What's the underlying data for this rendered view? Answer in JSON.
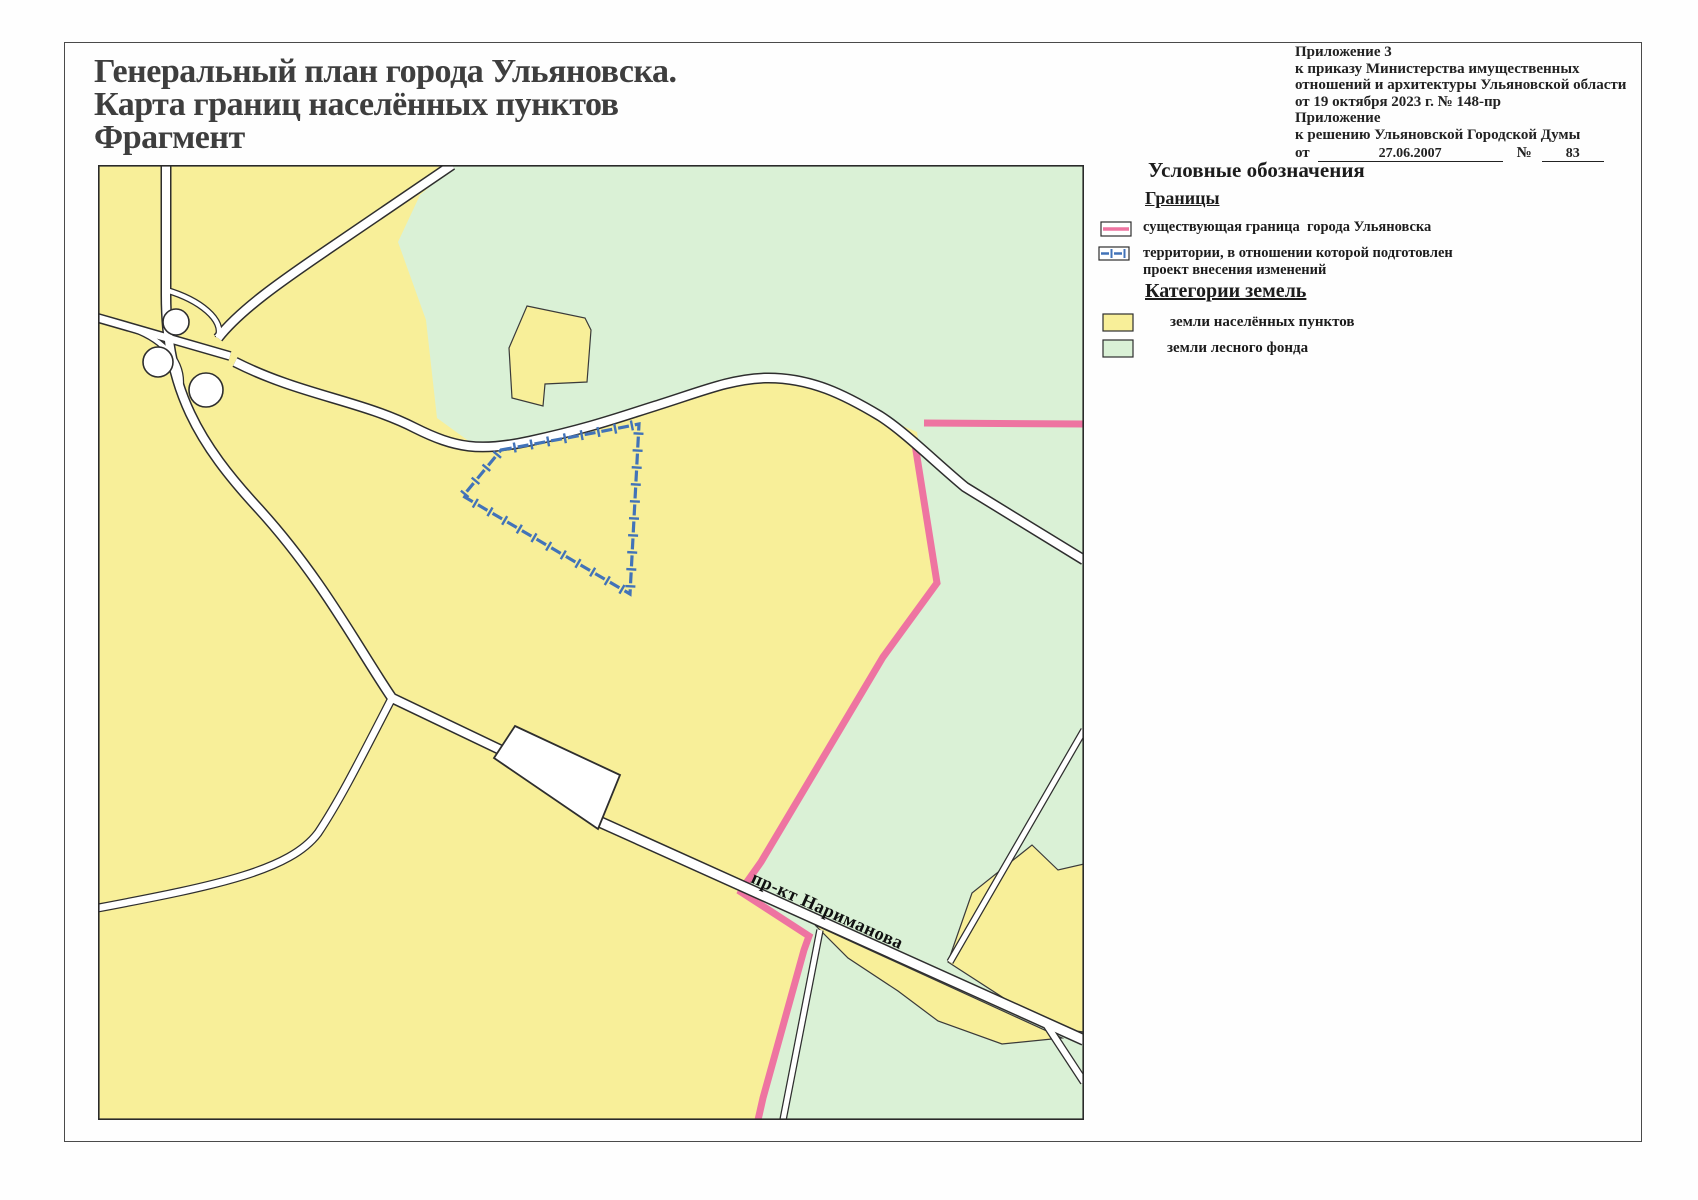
{
  "page": {
    "title_lines": [
      "Генеральный план города Ульяновска.",
      "Карта границ населённых пунктов",
      "Фрагмент"
    ]
  },
  "annotation": {
    "lines": [
      "Приложение 3",
      "к приказу Министерства имущественных",
      "отношений и архитектуры Ульяновской области",
      "от 19 октября 2023 г. № 148-пр",
      "Приложение",
      "к решению Ульяновской Городской Думы"
    ],
    "date_prefix": "от",
    "date_value": "27.06.2007",
    "number_sign": "№",
    "number_value": "83"
  },
  "legend": {
    "title": "Условные обозначения",
    "sections": [
      {
        "heading": "Границы",
        "items": [
          {
            "swatch": "pink-boundary-line",
            "label": "существующая граница  города Ульяновска"
          },
          {
            "swatch": "blue-dashed-line",
            "label": "территории, в отношении которой подготовлен проект внесения изменений"
          }
        ]
      },
      {
        "heading": "Категории земель",
        "items": [
          {
            "swatch": "yellow-fill",
            "label": "земли населённых пунктов"
          },
          {
            "swatch": "green-fill",
            "label": "земли лесного фонда"
          }
        ]
      }
    ]
  },
  "map": {
    "road_label": "пр-кт Нариманова"
  },
  "colors": {
    "settlement_yellow": "#f8ef99",
    "forest_green": "#daf1d6",
    "boundary_pink": "#ee74a1",
    "project_blue": "#4273b8",
    "road_casing": "#2e2e2e",
    "road_fill": "#ffffff",
    "frame": "#2a2a2a"
  }
}
